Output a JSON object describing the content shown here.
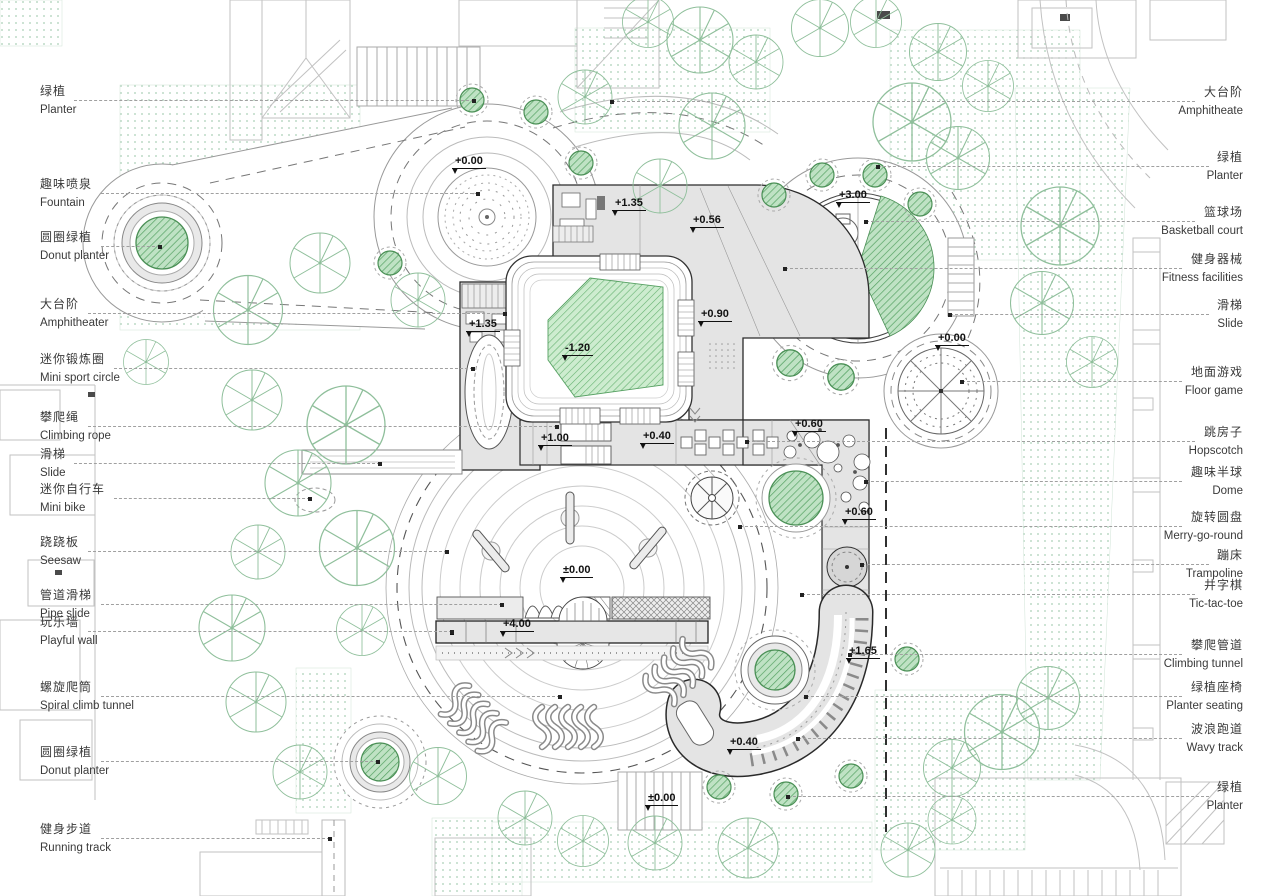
{
  "plan": {
    "labels": {
      "left": [
        {
          "zh": "绿植",
          "en": "Planter",
          "y": 101,
          "to": 474
        },
        {
          "zh": "趣味喷泉",
          "en": "Fountain",
          "y": 194,
          "to": 478
        },
        {
          "zh": "圆圈绿植",
          "en": "Donut planter",
          "y": 247,
          "to": 160
        },
        {
          "zh": "大台阶",
          "en": "Amphitheater",
          "y": 314,
          "to": 505
        },
        {
          "zh": "迷你锻炼圈",
          "en": "Mini sport circle",
          "y": 369,
          "to": 473
        },
        {
          "zh": "攀爬绳",
          "en": "Climbing rope",
          "y": 427,
          "to": 557
        },
        {
          "zh": "滑梯",
          "en": "Slide",
          "y": 464,
          "to": 380
        },
        {
          "zh": "迷你自行车",
          "en": "Mini bike",
          "y": 499,
          "to": 310
        },
        {
          "zh": "跷跷板",
          "en": "Seesaw",
          "y": 552,
          "to": 447
        },
        {
          "zh": "管道滑梯",
          "en": "Pipe slide",
          "y": 605,
          "to": 502
        },
        {
          "zh": "玩乐墙",
          "en": "Playful wall",
          "y": 632,
          "to": 452
        },
        {
          "zh": "螺旋爬筒",
          "en": "Spiral climb tunnel",
          "y": 697,
          "to": 560
        },
        {
          "zh": "圆圈绿植",
          "en": "Donut planter",
          "y": 762,
          "to": 378
        },
        {
          "zh": "健身步道",
          "en": "Running track",
          "y": 839,
          "to": 330
        }
      ],
      "right": [
        {
          "zh": "大台阶",
          "en": "Amphitheate",
          "y": 102,
          "to": 612
        },
        {
          "zh": "绿植",
          "en": "Planter",
          "y": 167,
          "to": 878
        },
        {
          "zh": "篮球场",
          "en": "Basketball court",
          "y": 222,
          "to": 866
        },
        {
          "zh": "健身器械",
          "en": "Fitness facilities",
          "y": 269,
          "to": 785
        },
        {
          "zh": "滑梯",
          "en": "Slide",
          "y": 315,
          "to": 950
        },
        {
          "zh": "地面游戏",
          "en": "Floor game",
          "y": 382,
          "to": 962
        },
        {
          "zh": "跳房子",
          "en": "Hopscotch",
          "y": 442,
          "to": 747
        },
        {
          "zh": "趣味半球",
          "en": "Dome",
          "y": 482,
          "to": 866
        },
        {
          "zh": "旋转圆盘",
          "en": "Merry-go-round",
          "y": 527,
          "to": 740
        },
        {
          "zh": "蹦床",
          "en": "Trampoline",
          "y": 565,
          "to": 862
        },
        {
          "zh": "井字棋",
          "en": "Tic-tac-toe",
          "y": 595,
          "to": 802
        },
        {
          "zh": "攀爬管道",
          "en": "Climbing tunnel",
          "y": 655,
          "to": 850
        },
        {
          "zh": "绿植座椅",
          "en": "Planter seating",
          "y": 697,
          "to": 806
        },
        {
          "zh": "波浪跑道",
          "en": "Wavy track",
          "y": 739,
          "to": 798
        },
        {
          "zh": "绿植",
          "en": "Planter",
          "y": 797,
          "to": 788
        }
      ]
    },
    "elevation_markers": [
      {
        "value": "+0.00",
        "x": 452,
        "y": 155
      },
      {
        "value": "+1.35",
        "x": 612,
        "y": 197
      },
      {
        "value": "+0.56",
        "x": 690,
        "y": 214
      },
      {
        "value": "+3.00",
        "x": 836,
        "y": 189
      },
      {
        "value": "+0.90",
        "x": 698,
        "y": 308
      },
      {
        "value": "+1.35",
        "x": 466,
        "y": 318
      },
      {
        "value": "-1.20",
        "x": 562,
        "y": 342
      },
      {
        "value": "+1.00",
        "x": 538,
        "y": 432
      },
      {
        "value": "+0.40",
        "x": 640,
        "y": 430
      },
      {
        "value": "+0.60",
        "x": 792,
        "y": 418
      },
      {
        "value": "+0.60",
        "x": 842,
        "y": 506
      },
      {
        "value": "±0.00",
        "x": 560,
        "y": 564
      },
      {
        "value": "+4.00",
        "x": 500,
        "y": 618
      },
      {
        "value": "+0.00",
        "x": 935,
        "y": 332
      },
      {
        "value": "+1.65",
        "x": 846,
        "y": 645
      },
      {
        "value": "+0.40",
        "x": 727,
        "y": 736
      },
      {
        "value": "±0.00",
        "x": 645,
        "y": 792
      }
    ],
    "colors": {
      "deck": "#e4e4e4",
      "outline": "#2a2a2a",
      "planter_green": "#bfe2c4",
      "planter_stroke": "#4a8f55",
      "lawn": "#cdeccf",
      "tree": "#8fbf9b",
      "texture_dot": "#a9cfb6",
      "leader": "#a0a0a0"
    }
  }
}
